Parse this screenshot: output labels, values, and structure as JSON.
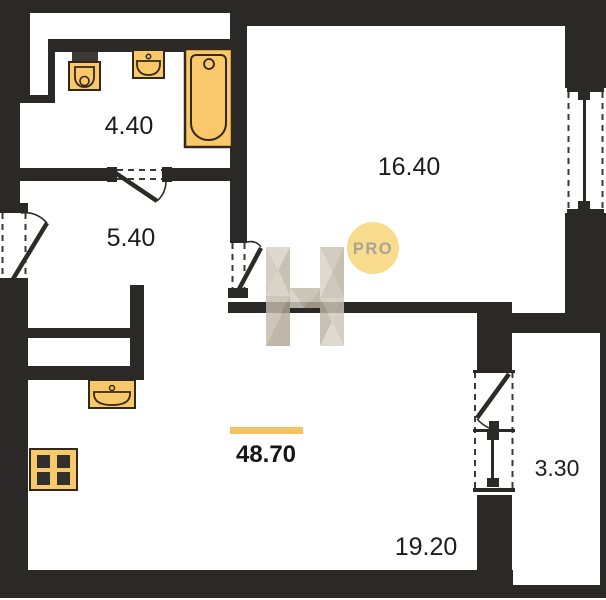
{
  "floorplan": {
    "type": "apartment-floor-plan",
    "total_area": {
      "value": "48.70",
      "overline_color": "#f3c262"
    },
    "rooms": [
      {
        "id": "bathroom",
        "area": "4.40",
        "fixtures": [
          "toilet",
          "sink",
          "bathtub"
        ]
      },
      {
        "id": "hallway",
        "area": "5.40",
        "fixtures": []
      },
      {
        "id": "bedroom",
        "area": "16.40",
        "fixtures": []
      },
      {
        "id": "living-kitchen",
        "area": "19.20",
        "fixtures": [
          "kitchen-sink",
          "stove"
        ]
      },
      {
        "id": "balcony",
        "area": "3.30",
        "fixtures": []
      }
    ],
    "doors": [
      "entrance-door",
      "bathroom-door",
      "hallway-door",
      "balcony-door"
    ],
    "windows": [
      "bedroom-window",
      "balcony-window"
    ],
    "watermark": {
      "pro_label": "PRO",
      "pro_circle_color": "#f8db8d",
      "pro_text_color": "#a8a399",
      "logo": "h-faceted-logo"
    },
    "colors": {
      "wall": "#2a2927",
      "background": "#ffffff",
      "fixture_fill": "#f9c86b",
      "fixture_stroke": "#33291a",
      "burner_dark": "#32302d",
      "label": "#1c1c1c",
      "accent_orange": "#f3c262"
    }
  }
}
